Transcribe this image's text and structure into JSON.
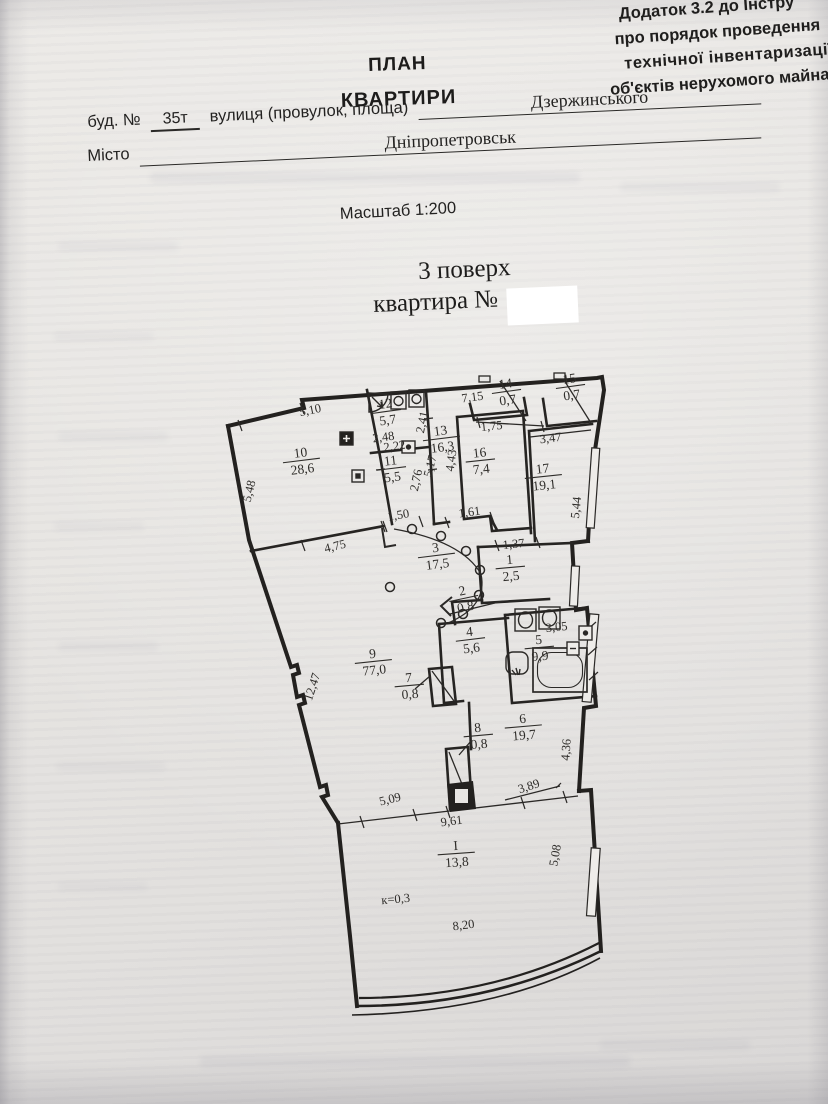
{
  "document": {
    "corner_note": [
      "Додаток 3.2 до Інстру",
      "про порядок проведення",
      "технічної  інвентаризації",
      "об'єктів нерухомого майна"
    ],
    "title_line1": "ПЛАН",
    "title_line2": "КВАРТИРИ",
    "form": {
      "building_label": "буд. №",
      "building_value": "35т",
      "street_label": "вулиця (провулок, площа)",
      "street_value": "Дзержинського",
      "city_label": "Місто",
      "city_value": "Дніпропетровськ"
    },
    "scale_text": "Масштаб 1:200",
    "floor_text": "3  поверх",
    "apartment_label": "квартира №"
  },
  "plan": {
    "coefficient": "к=0,3",
    "rooms": [
      {
        "n": "10",
        "a": "28,6",
        "x": 301,
        "y": 457,
        "r": -7
      },
      {
        "n": "12",
        "a": "5,7",
        "x": 386,
        "y": 408,
        "r": -8
      },
      {
        "n": "11",
        "a": "5,5",
        "x": 391,
        "y": 465,
        "r": -7
      },
      {
        "n": "13",
        "a": "16,3",
        "x": 441,
        "y": 435,
        "r": -7
      },
      {
        "n": "16",
        "a": "7,4",
        "x": 480,
        "y": 457,
        "r": -6
      },
      {
        "n": "14",
        "a": "0,7",
        "x": 506,
        "y": 388,
        "r": -8
      },
      {
        "n": "15",
        "a": "0,7",
        "x": 570,
        "y": 383,
        "r": -8
      },
      {
        "n": "17",
        "a": "19,1",
        "x": 543,
        "y": 473,
        "r": -6
      },
      {
        "n": "3",
        "a": "17,5",
        "x": 436,
        "y": 552,
        "r": -7
      },
      {
        "n": "1",
        "a": "2,5",
        "x": 510,
        "y": 564,
        "r": -5
      },
      {
        "n": "2",
        "a": "0,8",
        "x": 463,
        "y": 595,
        "r": -12
      },
      {
        "n": "4",
        "a": "5,6",
        "x": 470,
        "y": 636,
        "r": -7
      },
      {
        "n": "5",
        "a": "9,9",
        "x": 539,
        "y": 644,
        "r": -5
      },
      {
        "n": "7",
        "a": "0,8",
        "x": 409,
        "y": 682,
        "r": -5
      },
      {
        "n": "8",
        "a": "0,8",
        "x": 478,
        "y": 732,
        "r": -5
      },
      {
        "n": "9",
        "a": "77,0",
        "x": 373,
        "y": 658,
        "r": -6
      },
      {
        "n": "6",
        "a": "19,7",
        "x": 523,
        "y": 723,
        "r": -5
      },
      {
        "n": "I",
        "a": "13,8",
        "x": 456,
        "y": 850,
        "r": -4
      }
    ],
    "dims": [
      {
        "t": "5,10",
        "x": 311,
        "y": 414,
        "r": -12
      },
      {
        "t": "5,48",
        "x": 253,
        "y": 492,
        "r": -76
      },
      {
        "t": "2,48",
        "x": 384,
        "y": 441,
        "r": -8
      },
      {
        "t": "2,41",
        "x": 426,
        "y": 423,
        "r": -78
      },
      {
        "t": "2,22",
        "x": 395,
        "y": 450,
        "r": -8
      },
      {
        "t": "2,76",
        "x": 420,
        "y": 481,
        "r": -78
      },
      {
        "t": "5,17",
        "x": 434,
        "y": 467,
        "r": -76
      },
      {
        "t": "7,15",
        "x": 473,
        "y": 401,
        "r": -8
      },
      {
        "t": "1,75",
        "x": 492,
        "y": 430,
        "r": -6
      },
      {
        "t": "4,43",
        "x": 455,
        "y": 461,
        "r": -82
      },
      {
        "t": "3,47",
        "x": 551,
        "y": 442,
        "r": -7
      },
      {
        "t": "5,44",
        "x": 580,
        "y": 508,
        "r": -84
      },
      {
        "t": "1,37",
        "x": 514,
        "y": 548,
        "r": -6
      },
      {
        "t": "1,50",
        "x": 399,
        "y": 519,
        "r": -10
      },
      {
        "t": "1,61",
        "x": 470,
        "y": 516,
        "r": -8
      },
      {
        "t": "3,05",
        "x": 557,
        "y": 631,
        "r": -6
      },
      {
        "t": "4,75",
        "x": 336,
        "y": 550,
        "r": -14
      },
      {
        "t": "12,47",
        "x": 316,
        "y": 688,
        "r": -72
      },
      {
        "t": "4,36",
        "x": 570,
        "y": 750,
        "r": -86
      },
      {
        "t": "5,09",
        "x": 391,
        "y": 803,
        "r": -14
      },
      {
        "t": "9,61",
        "x": 452,
        "y": 825,
        "r": -7
      },
      {
        "t": "3,89",
        "x": 530,
        "y": 790,
        "r": -18
      },
      {
        "t": "5,08",
        "x": 559,
        "y": 856,
        "r": -80
      },
      {
        "t": "8,20",
        "x": 464,
        "y": 929,
        "r": -7
      },
      {
        "t": "к=0,3",
        "x": 396,
        "y": 903,
        "r": -5
      }
    ]
  },
  "colors": {
    "ink": "#2a2927",
    "paper": "#e8e6e3",
    "redaction": "#ffffff"
  }
}
